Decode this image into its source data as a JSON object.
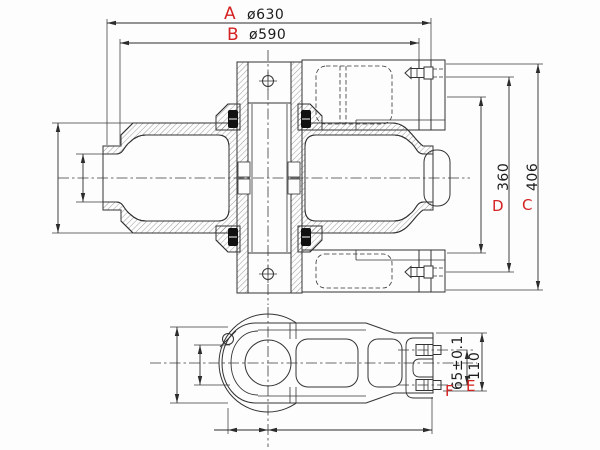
{
  "drawing": {
    "type": "engineering-cad-section-drawing",
    "colors": {
      "background": "#fdfdfd",
      "line": "#333333",
      "label_accent": "#d42222"
    },
    "dimensions": {
      "A": {
        "label": "A",
        "value": "ø630"
      },
      "B": {
        "label": "B",
        "value": "ø590"
      },
      "C": {
        "label": "C",
        "value": "406"
      },
      "D": {
        "label": "D",
        "value": "360"
      },
      "E": {
        "label": "E",
        "value": "110"
      },
      "F": {
        "label": "F",
        "value": "65±0.1"
      }
    }
  }
}
